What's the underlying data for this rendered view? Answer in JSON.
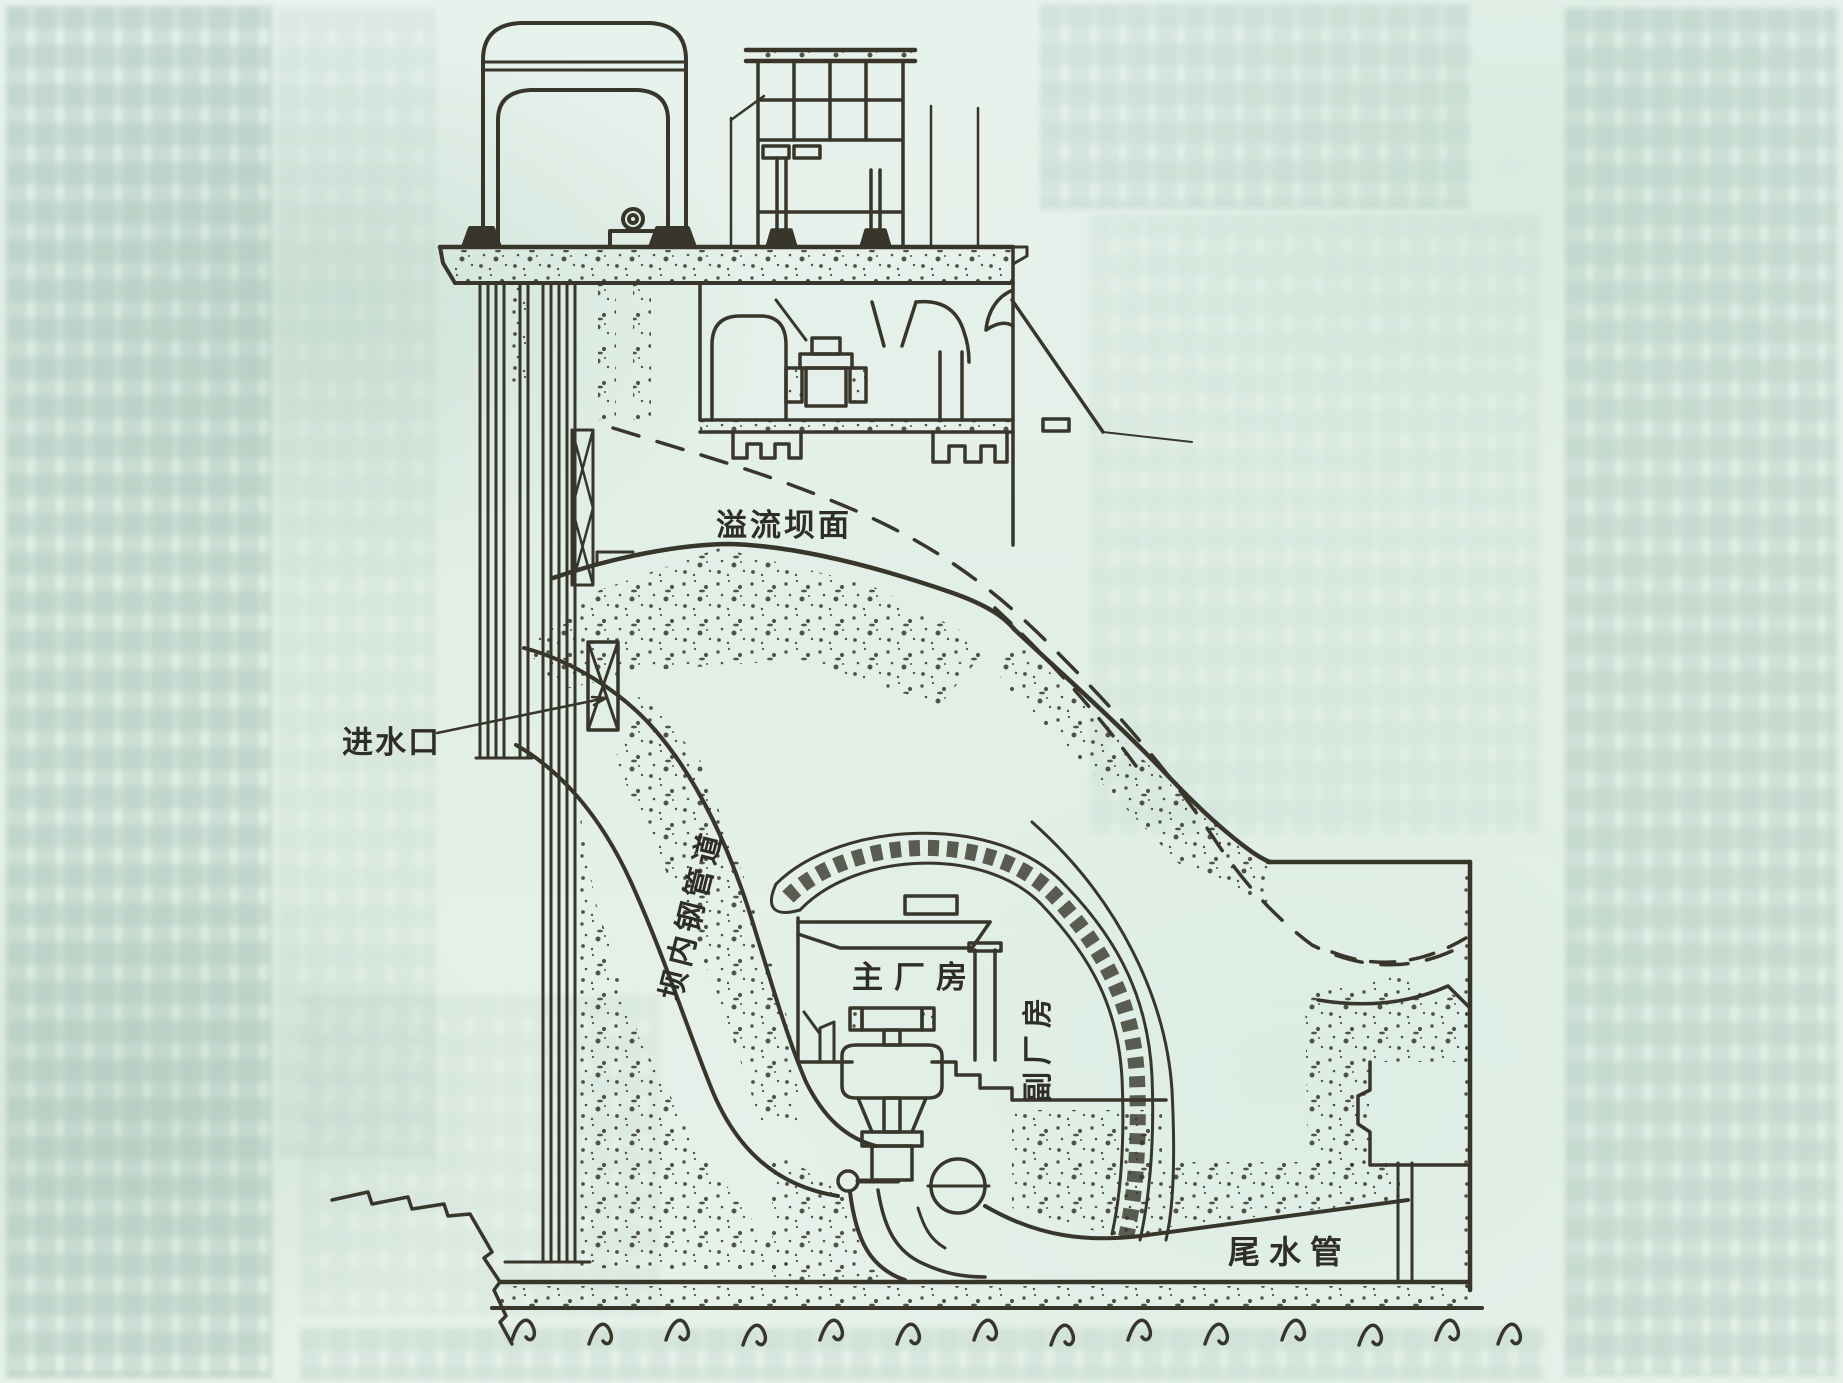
{
  "page": {
    "paper_color": "#e4f0e9",
    "ink_color": "#38362b",
    "bleed_text_color": "#8eb0a3"
  },
  "diagram": {
    "labels": {
      "spillway_face": "溢流坝面",
      "intake": "进水口",
      "penstock": "坝内钢管道",
      "main_powerhouse": "主厂房",
      "auxiliary_powerhouse": "副厂房",
      "draft_tube": "尾水管"
    }
  }
}
